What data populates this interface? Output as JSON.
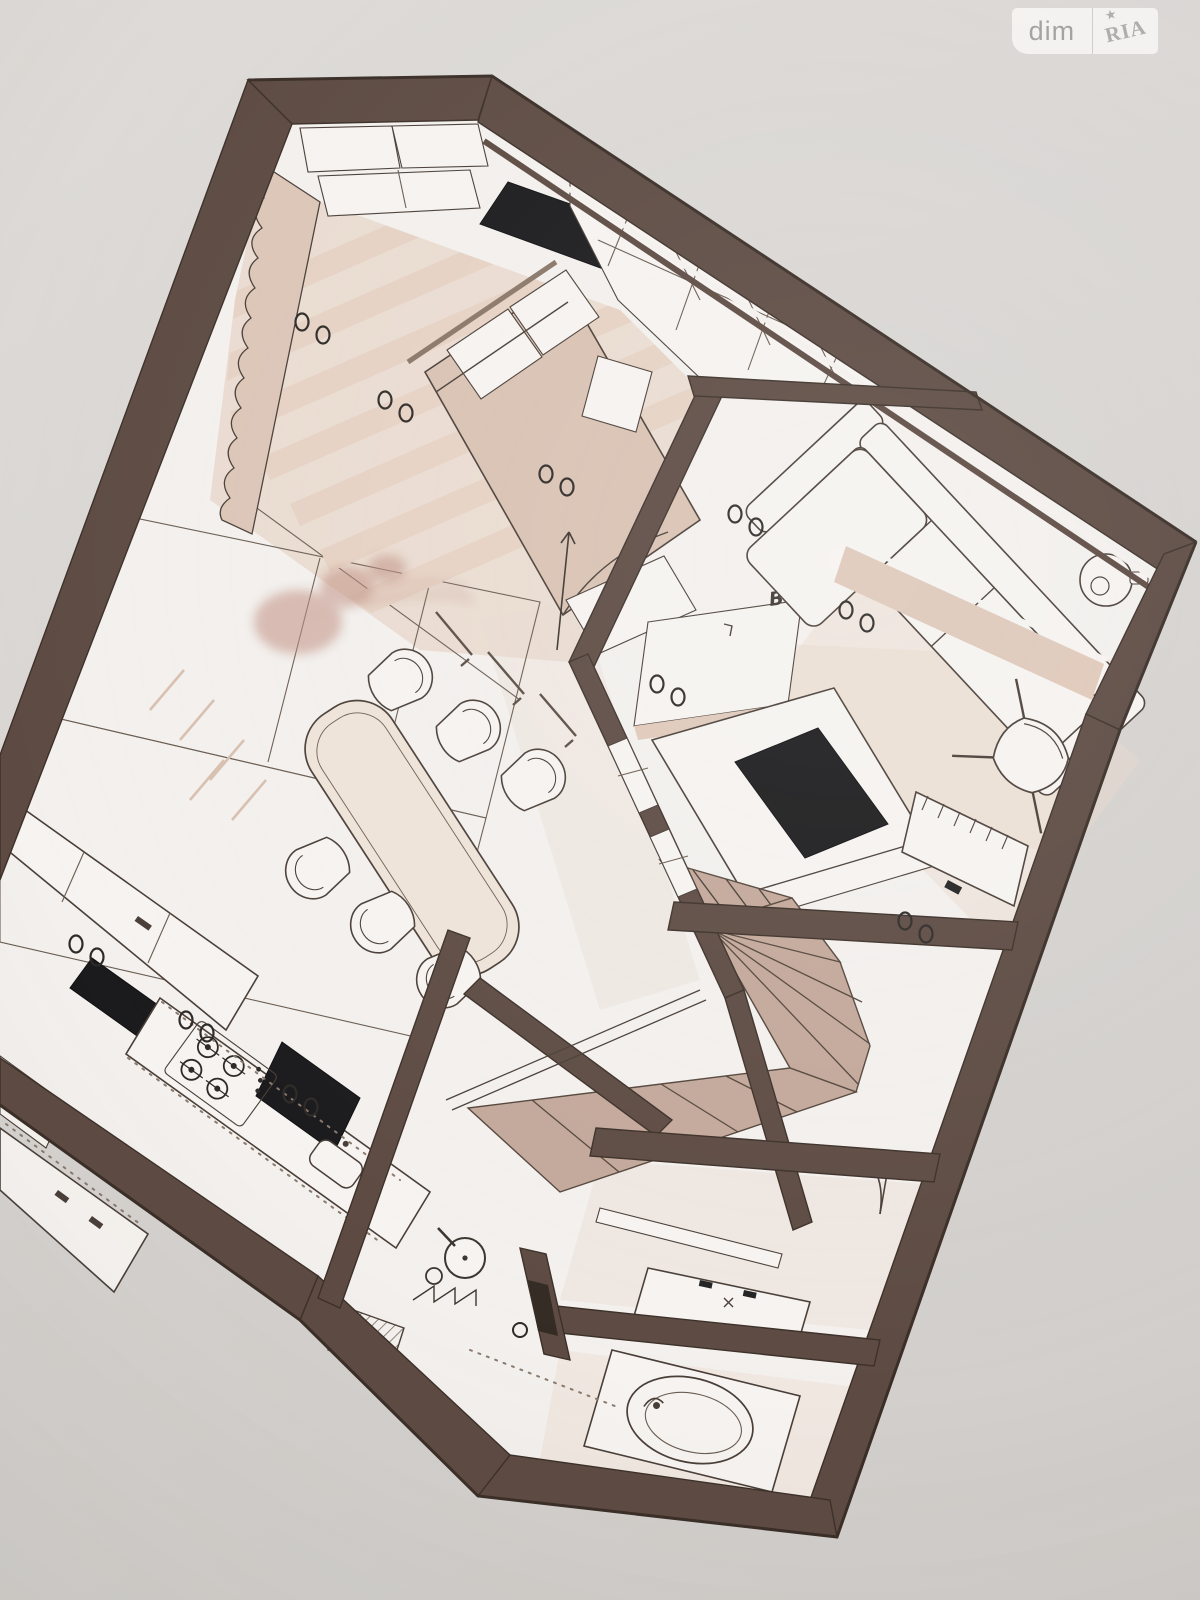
{
  "scene": {
    "kind": "photographed 3D axonometric interior floor plan",
    "orientation": "plan rotated ~23 degrees on photo paper",
    "levels_shown": 1
  },
  "watermark": {
    "brand_left": "dim",
    "brand_right": "RIA",
    "star_glyph": "★"
  },
  "annotations": {
    "marker": "B"
  },
  "palette": {
    "photo_background": "#d7d3d1",
    "plan_floor": "#f3f0ed",
    "wall_brown": "#5d4b43",
    "wall_outline": "#3c3029",
    "furniture_line": "#4a3f38",
    "floor_beige": "#e9d8cb",
    "textile_beige": "#d9c2b3",
    "stair_wood": "#c3a89a",
    "appliance_black": "#1b1b1d",
    "plant_shadow_pink": "#c08e80"
  },
  "depicted": {
    "bedroom": [
      "curtain wall",
      "slatted floor stripes",
      "double bed with pillows",
      "bench",
      "wall TV panel",
      "closet boxes",
      "corner shelving"
    ],
    "living_room": [
      "corner sofa with chaise",
      "round side table",
      "lounge chair",
      "area rug",
      "marker B"
    ],
    "study": [
      "desk",
      "black desk pad",
      "desk chair",
      "radiator"
    ],
    "staircase": [
      "winder stairs",
      "stringer rails",
      "guard walls"
    ],
    "dining": [
      "oval table",
      "six chairs",
      "pendant lights",
      "plant shadow"
    ],
    "kitchen": [
      "wall cabinets",
      "black backsplash",
      "gas hob",
      "sink",
      "island",
      "LED dotted lines"
    ],
    "dressing_room": [
      "mirror strip",
      "vanity with two taps",
      "swing door"
    ],
    "bathroom": [
      "bathtub",
      "shower head",
      "bench",
      "glass screen dotted line",
      "towel zigzag"
    ],
    "symbols": [
      "paired ceiling spotlights"
    ]
  }
}
